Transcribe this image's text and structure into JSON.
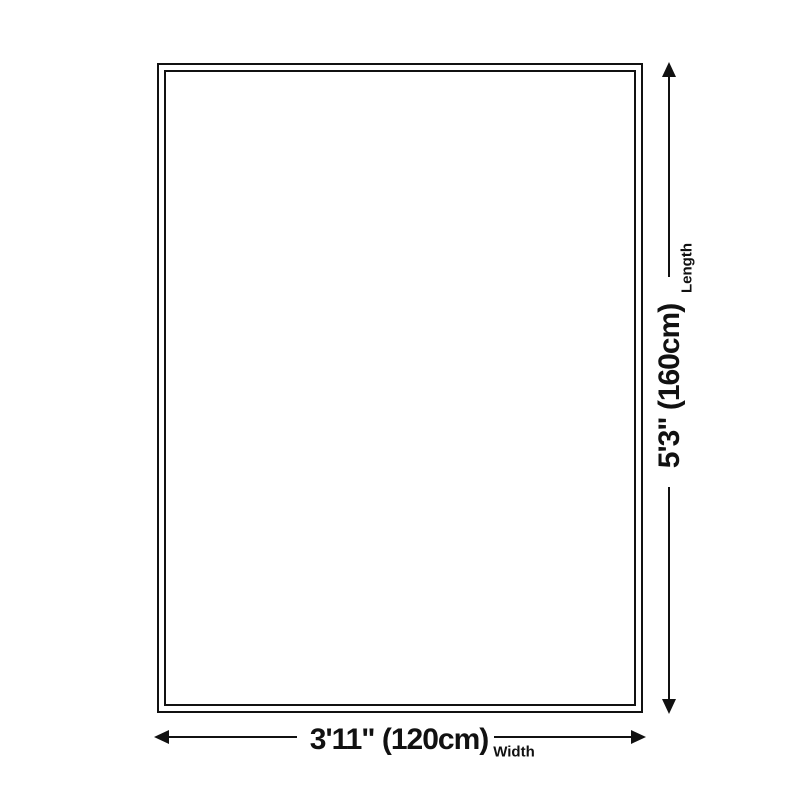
{
  "colors": {
    "background": "#ffffff",
    "ink": "#111111"
  },
  "length_dimension": {
    "value": "5'3\" (160cm)",
    "label": "Length"
  },
  "width_dimension": {
    "value": "3'11\" (120cm)",
    "label": "Width"
  }
}
